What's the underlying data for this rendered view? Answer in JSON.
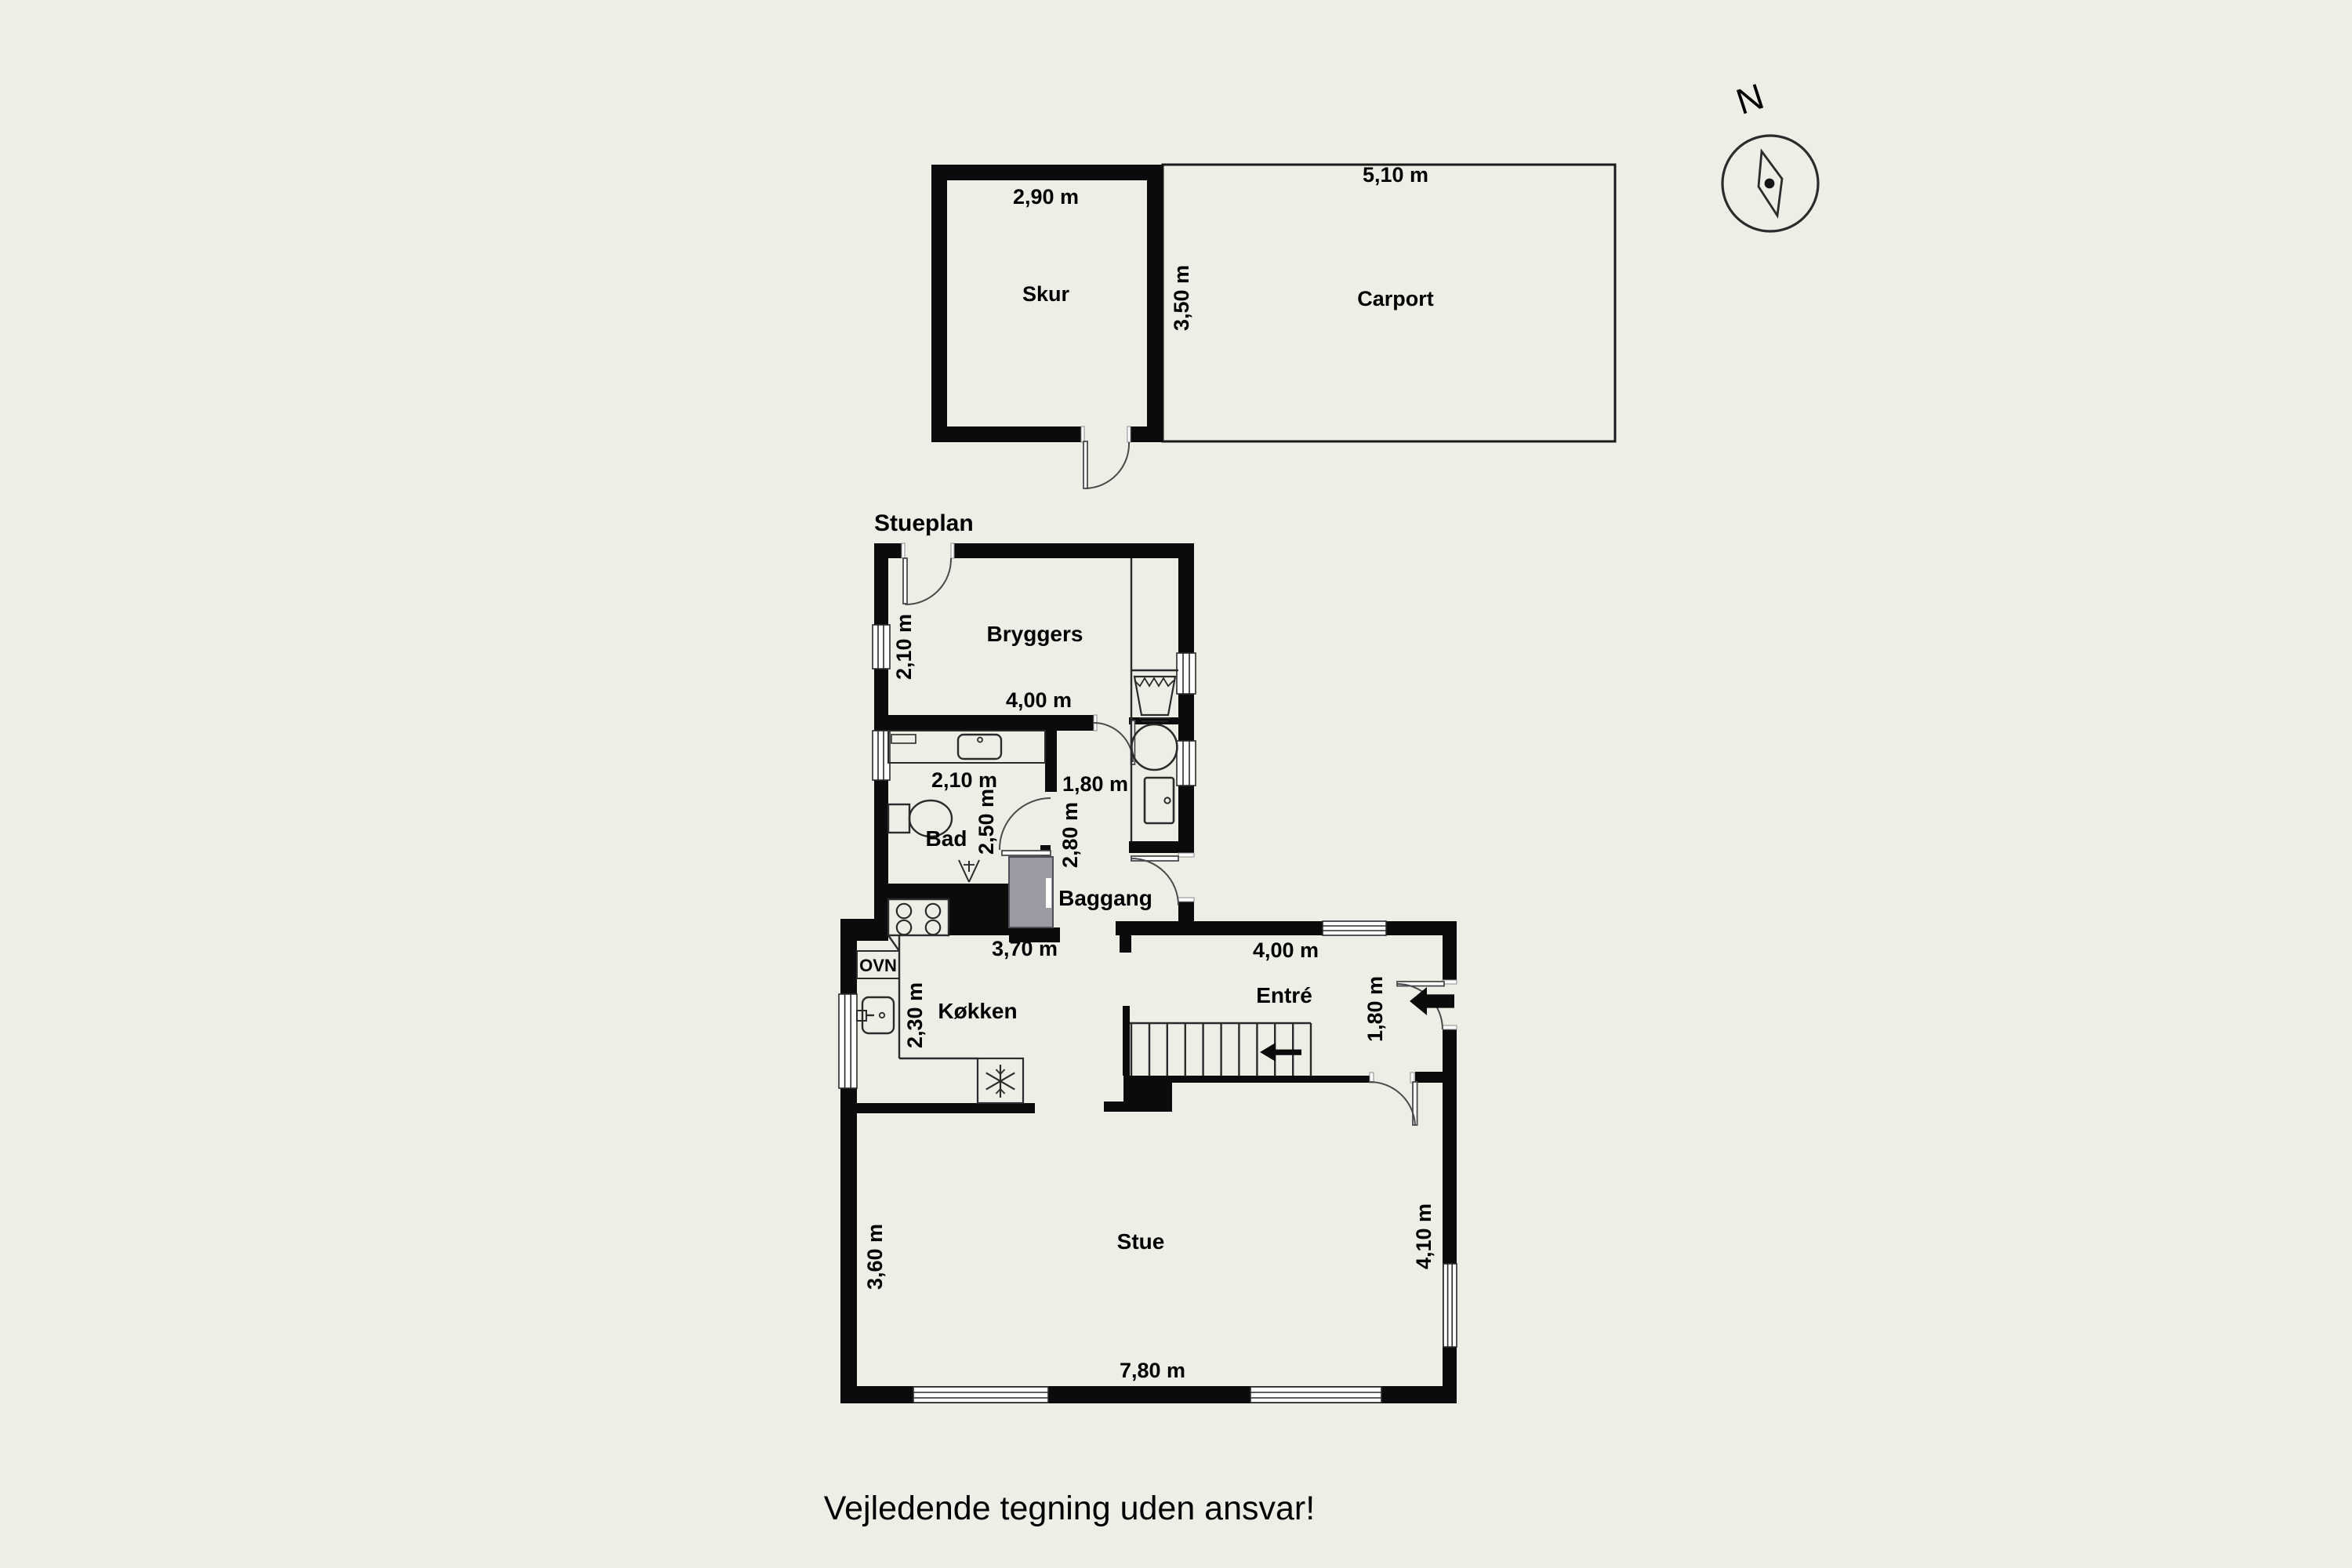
{
  "page": {
    "title": "Stueplan",
    "disclaimer": "Vejledende tegning uden ansvar!"
  },
  "compass": {
    "north": "N"
  },
  "outbuildings": {
    "skur": {
      "name": "Skur",
      "width": "2,90 m"
    },
    "carport": {
      "name": "Carport",
      "width": "5,10 m",
      "depth": "3,50 m"
    }
  },
  "rooms": {
    "bryggers": {
      "name": "Bryggers",
      "width": "4,00 m",
      "depth": "2,10 m"
    },
    "bad": {
      "name": "Bad",
      "width": "2,10 m",
      "depth": "2,50 m"
    },
    "baggang": {
      "name": "Baggang",
      "passage_width": "1,80 m",
      "depth": "2,80 m"
    },
    "kokken": {
      "name": "Køkken",
      "width": "3,70 m",
      "depth": "2,30 m",
      "appliance": "OVN"
    },
    "entre": {
      "name": "Entré",
      "width": "4,00 m",
      "entry": "1,80 m"
    },
    "stue": {
      "name": "Stue",
      "width": "7,80 m",
      "depth_left": "3,60 m",
      "depth_right": "4,10 m"
    }
  },
  "colors": {
    "background": "#efeee6",
    "wall": "#0b0b0b",
    "chimney": "#9b99a1",
    "line": "#2b2b2b"
  }
}
